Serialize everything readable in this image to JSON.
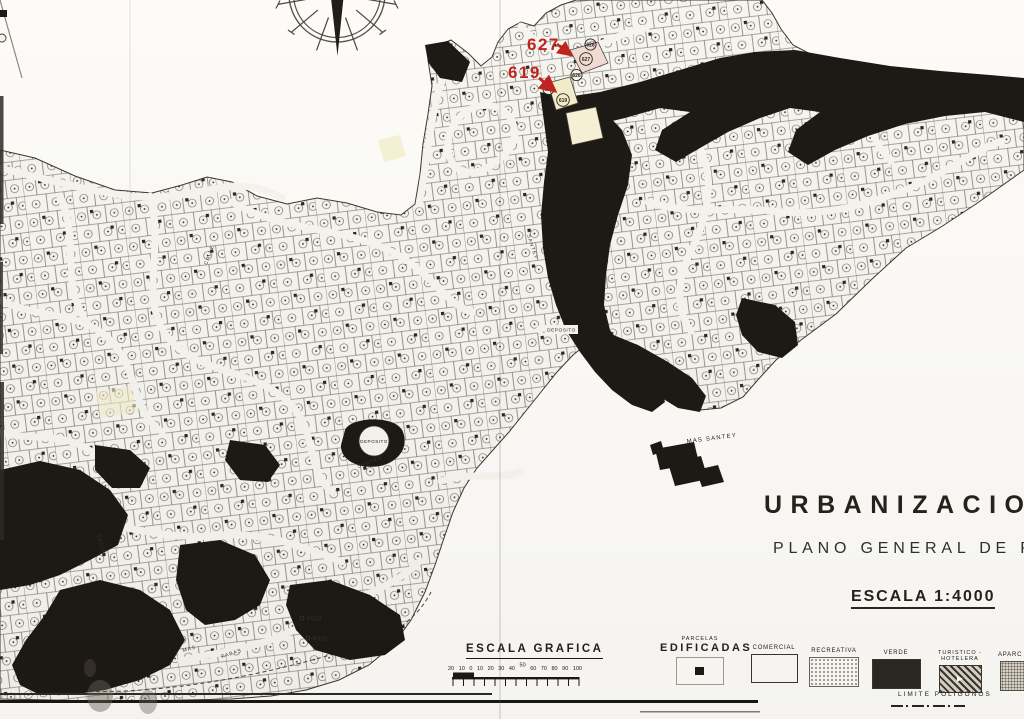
{
  "red_annotations": {
    "color": "#c22320",
    "labels": [
      {
        "text": "627"
      },
      {
        "text": "619"
      }
    ]
  },
  "map": {
    "highlight_parcels": [
      {
        "number": "627",
        "fill": "#f0dbd2"
      },
      {
        "number": "619",
        "fill": "#f2ecca"
      }
    ],
    "neighbor_parcels": [
      "628",
      "626",
      "618"
    ],
    "labels": {
      "mas_santey": "MAS SANTEY",
      "deposito_a": "DEPOSITO",
      "deposito_b": "DEPOSITO",
      "pozo_a": "POZO",
      "pozo_b": "POZO"
    },
    "street_labels": [
      "CALLE",
      "MAS",
      "FABAS",
      "SANTEY",
      "CALLE",
      "SANTEY"
    ]
  },
  "title_block": {
    "line1": "URBANIZACION \"MA",
    "line2": "PLANO GENERAL DE PARC",
    "scale": "ESCALA 1:4000"
  },
  "graphic_scale": {
    "title": "ESCALA GRAFICA",
    "ticks": [
      "20",
      "10",
      "0",
      "10",
      "20",
      "30",
      "40",
      "50",
      "60",
      "70",
      "80",
      "90",
      "100"
    ]
  },
  "legend": {
    "edificadas_top": "PARCELAS",
    "edificadas": "EDIFICADAS",
    "comercial": "COMERCIAL",
    "recreativa": "RECREATIVA",
    "verde": "VERDE",
    "turistico": "TURISTICO - HOTELERA",
    "aparcamiento": "APARC",
    "limite": "LIMITE POLIGONOS"
  }
}
